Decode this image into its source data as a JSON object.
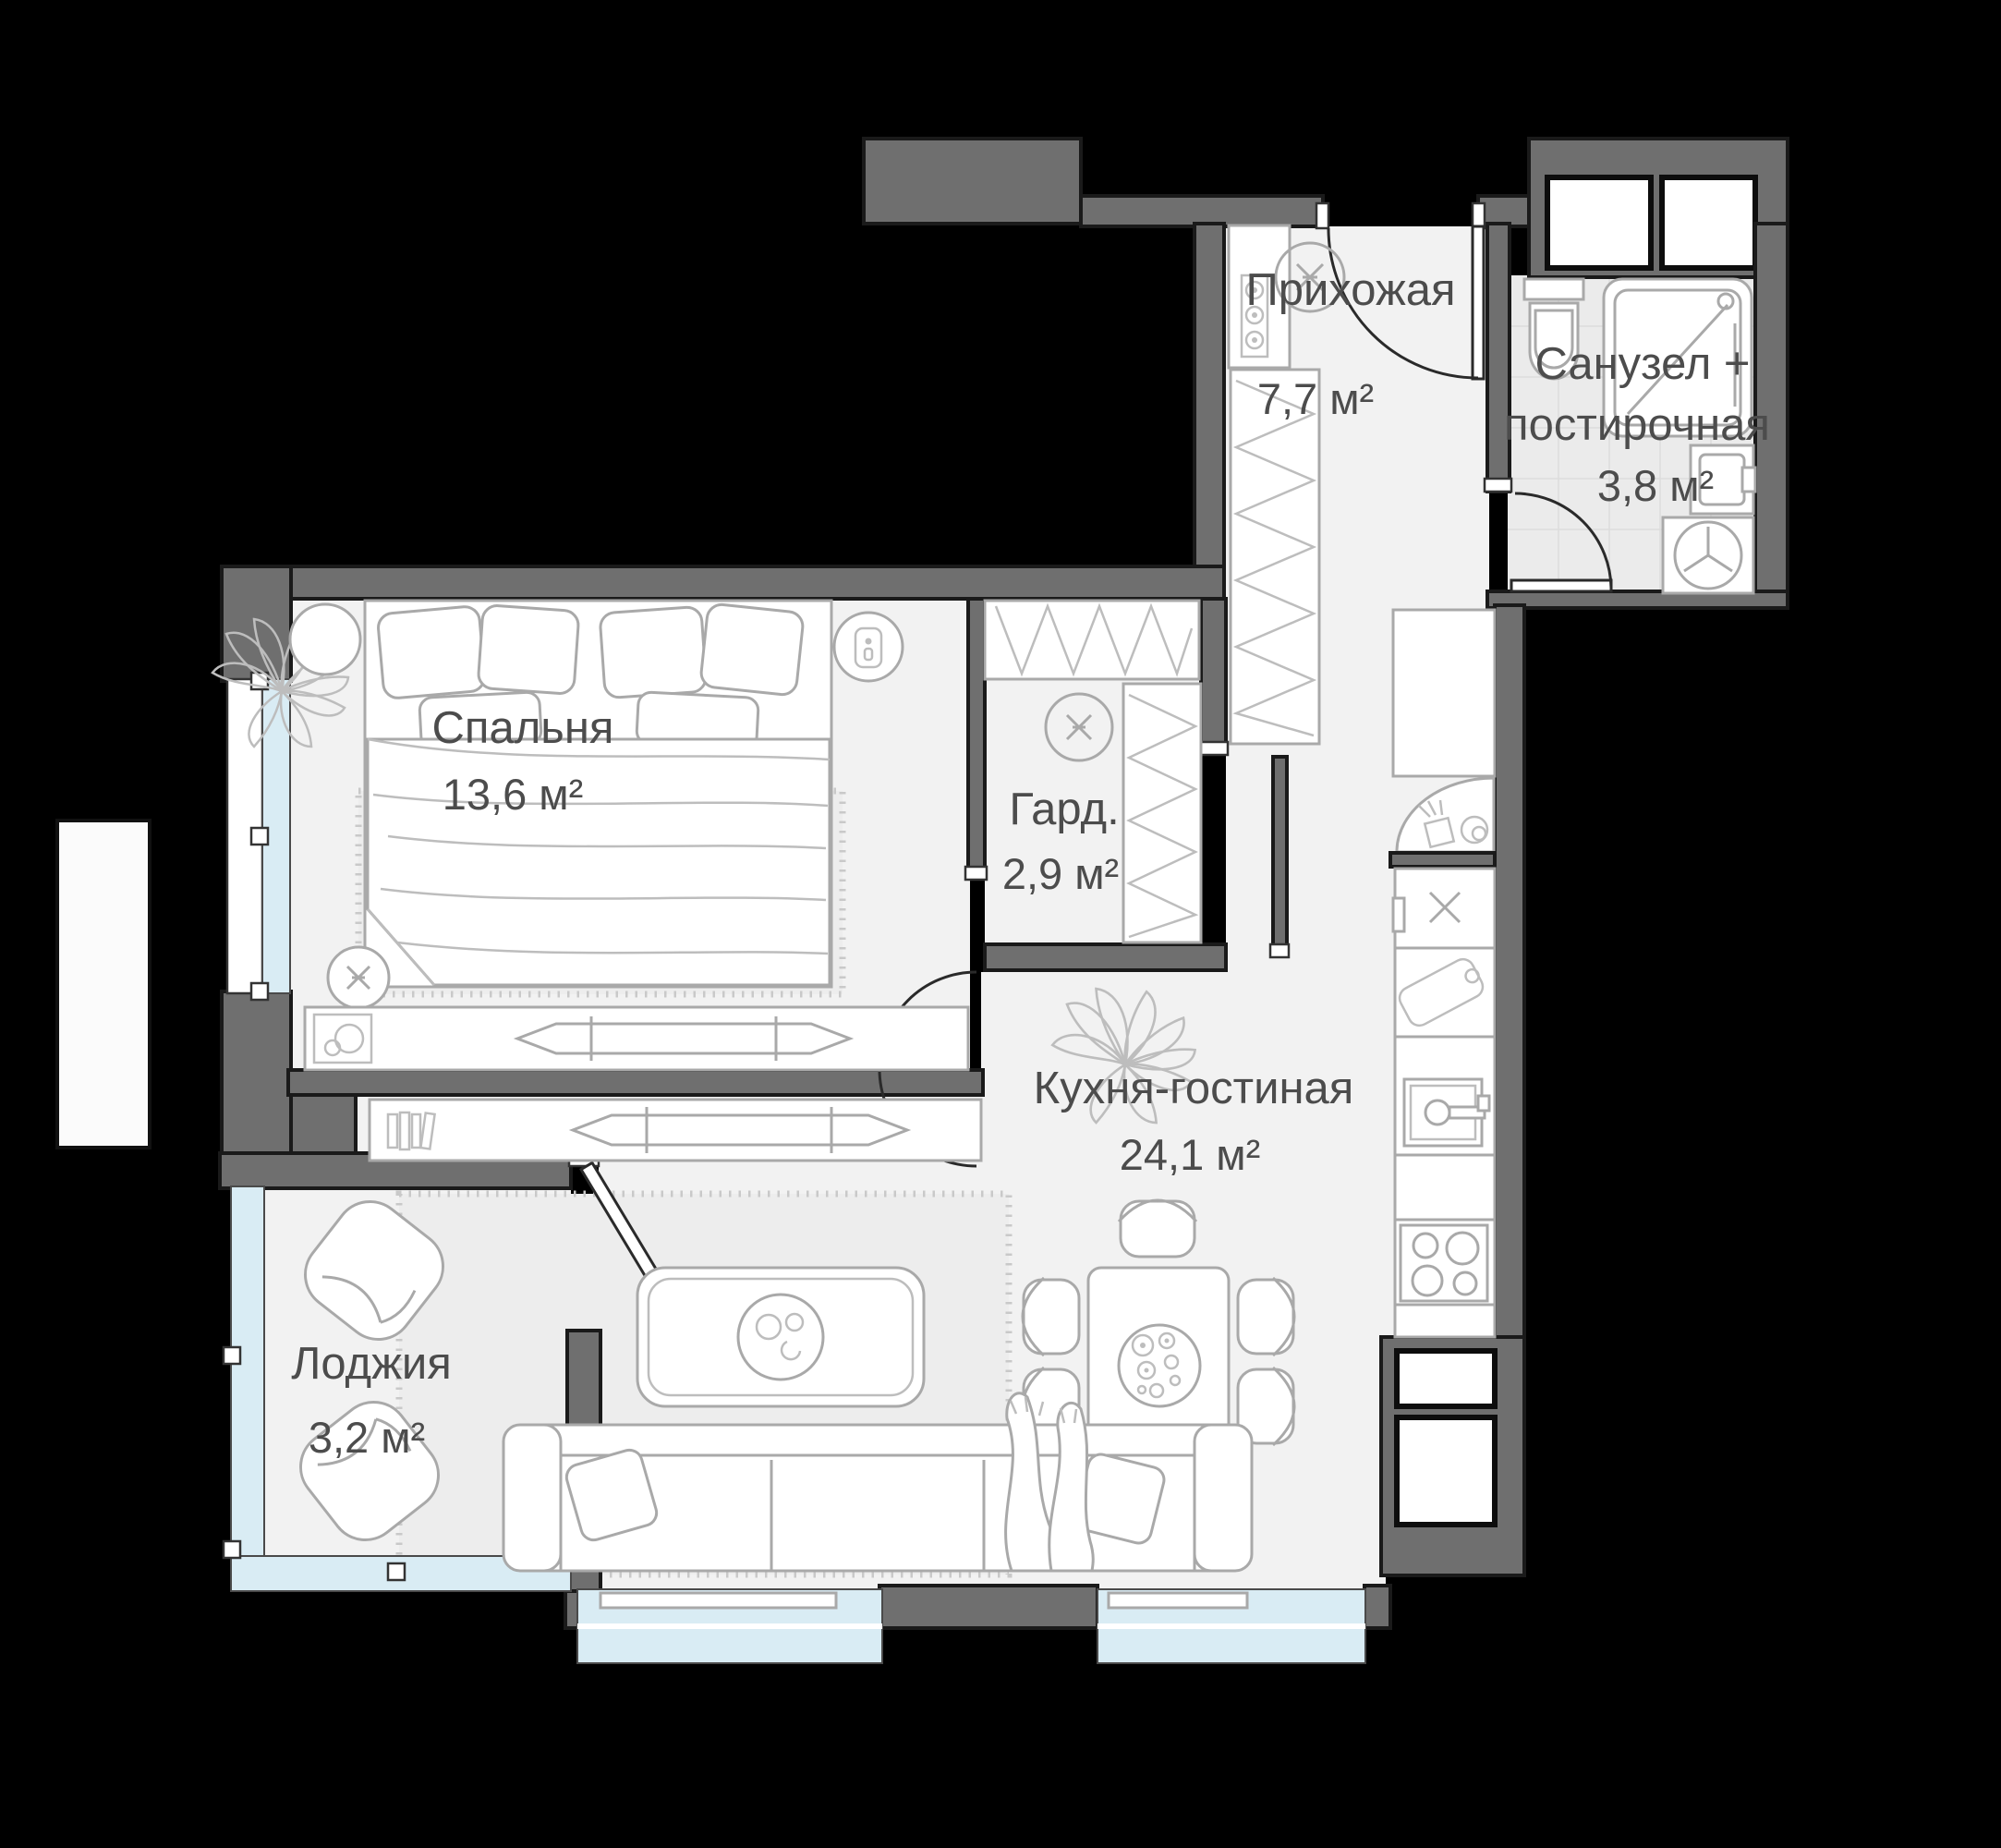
{
  "plan": {
    "type": "apartment-floor-plan",
    "language": "ru",
    "rooms": [
      {
        "id": "hallway",
        "label": "Прихожая",
        "area": "7,7 м²"
      },
      {
        "id": "bathroom",
        "label_line1": "Санузел +",
        "label_line2": "постирочная",
        "area": "3,8 м²"
      },
      {
        "id": "wardrobe",
        "label": "Гард.",
        "area": "2,9 м²"
      },
      {
        "id": "bedroom",
        "label": "Спальня",
        "area": "13,6 м²"
      },
      {
        "id": "kitchen_living",
        "label": "Кухня-гостиная",
        "area": "24,1 м²"
      },
      {
        "id": "loggia",
        "label": "Лоджия",
        "area": "3,2 м²"
      }
    ],
    "icons": [
      "entrance-door-arc",
      "bathroom-door-arc",
      "bedroom-door-arc",
      "loggia-door-leaf",
      "toilet-icon",
      "shower-icon",
      "washer-icon",
      "bathroom-sink-icon",
      "electric-panel-icon",
      "ceiling-light-icon",
      "wardrobe-hatch",
      "fridge-icon",
      "kitchen-sink-icon",
      "stove-icon",
      "cutting-board-icon",
      "dining-table",
      "chair",
      "sofa",
      "coffee-table",
      "tv-icon",
      "bed",
      "plant-icon",
      "armchair",
      "radiator",
      "window"
    ]
  },
  "colors": {
    "background": "#000000",
    "wall": "#6f6f6f",
    "wall_outline": "#1a1a1a",
    "floor": "#f2f2f2",
    "bathroom_tile": "#ebebeb",
    "window_glass": "#d9ecf4",
    "furniture_stroke": "#a9a9a9",
    "label_text": "#4c4c4c"
  }
}
